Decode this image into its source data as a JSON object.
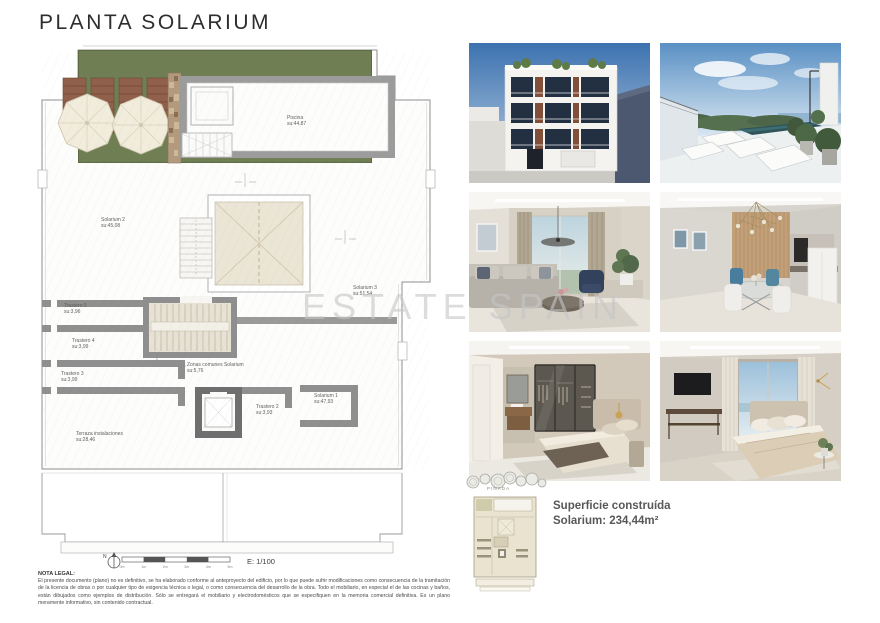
{
  "title": "PLANTA SOLARIUM",
  "watermark": "ESTATE SPAIN",
  "plan": {
    "rooms": {
      "piscina": {
        "name": "Piscina",
        "area": "su:44,87"
      },
      "solarium2": {
        "name": "Solarium 2",
        "area": "su:45,08"
      },
      "solarium3": {
        "name": "Solarium 3",
        "area": "su:51,54"
      },
      "solarium1": {
        "name": "Solarium 1",
        "area": "su:47,93"
      },
      "trastero5": {
        "name": "Trastero 5",
        "area": "su:3,96"
      },
      "trastero4": {
        "name": "Trastero 4",
        "area": "su:3,99"
      },
      "trastero3": {
        "name": "Trastero 3",
        "area": "su:3,99"
      },
      "trastero2": {
        "name": "Trastero 2",
        "area": "su:3,93"
      },
      "zonas": {
        "name": "Zonas comunes Solarium",
        "area": "su:5,76"
      },
      "terraza": {
        "name": "Terraza instalaciones",
        "area": "su:28,46"
      }
    },
    "scale": {
      "label": "E: 1/100",
      "north": "N",
      "ticks": [
        "0m",
        "1m",
        "2m",
        "3m",
        "4m",
        "5m"
      ]
    }
  },
  "site": {
    "label": "PINADA"
  },
  "summary": {
    "title": "Superficie construída",
    "value": "Solarium: 234,44m²"
  },
  "legal": {
    "heading": "NOTA LEGAL:",
    "body": "El presente documento (plano) no es definitivo, se ha elaborado conforme al anteproyecto del edificio, por lo que puede sufrir modificaciones como consecuencia de la tramitación de la licencia de obras o por cualquier tipo de exigencia técnica o legal, o como consecuencia del desarrollo de la obra. Todo el mobiliario, en especial el de las cocinas y baños, están dibujados como ejemplos de distribución. Sólo se entregará el mobiliario y electrodomésticos que se especifiquen en la memoria comercial definitiva. Es un plano meramente informativo, sin contenido contractual."
  },
  "colors": {
    "grass": "#6f7f53",
    "wall_gray": "#8f8f8f",
    "skylight_beige": "#ebe5d5",
    "summary_text": "#57585a"
  }
}
